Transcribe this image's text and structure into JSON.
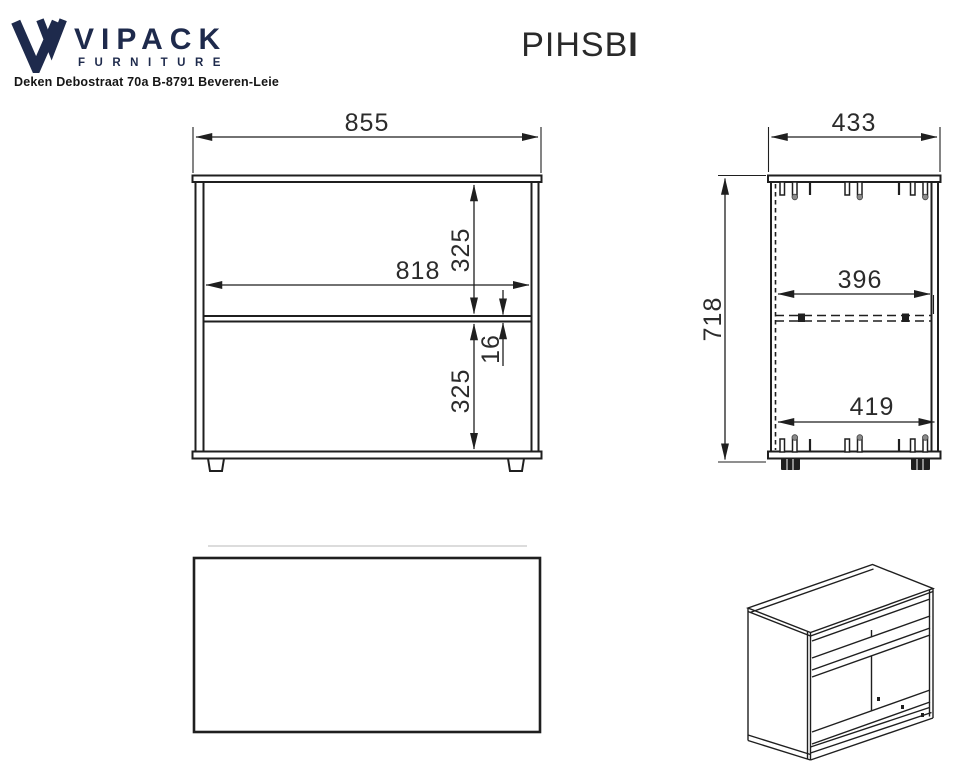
{
  "sheet": {
    "brand": {
      "name": "VIPACK",
      "subtitle": "FURNITURE",
      "address": "Deken Debostraat 70a B-8791 Beveren-Leie"
    },
    "title": {
      "main": "PIHSB",
      "suffix": "I"
    },
    "drawing": {
      "front_view": {
        "overall_width": "855",
        "inner_width": "818",
        "upper_compartment_height": "325",
        "shelf_thickness": "16",
        "lower_compartment_height": "325"
      },
      "side_view": {
        "overall_depth": "433",
        "overall_height": "718",
        "shelf_depth": "396",
        "bottom_panel_depth": "419"
      }
    },
    "colors": {
      "brand_navy": "#1e2a4c",
      "line": "#1f1f1f",
      "dim_text": "#2b2b2b"
    }
  }
}
